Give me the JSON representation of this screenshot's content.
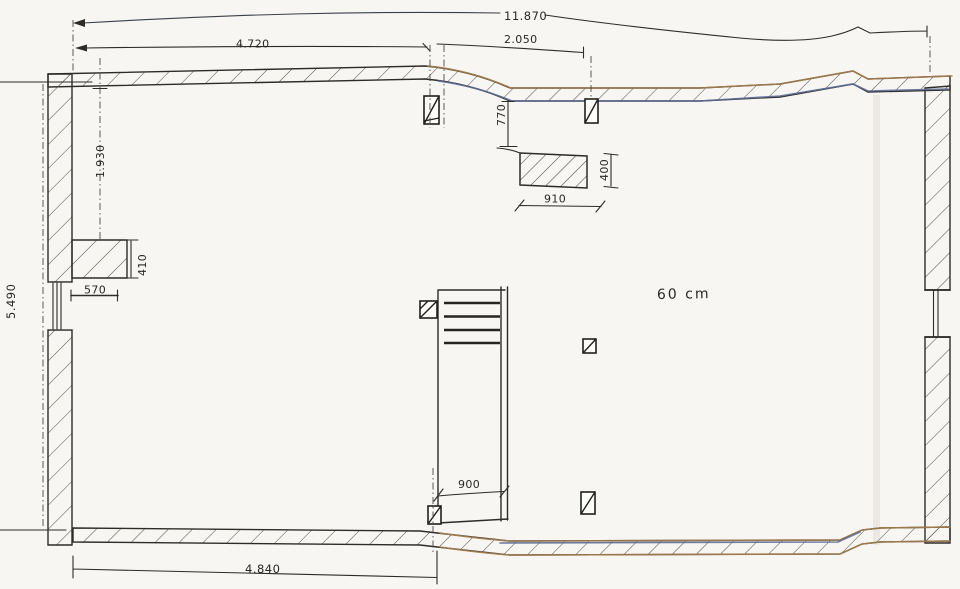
{
  "drawing": {
    "note": "60 cm",
    "dims": {
      "total_top": "11.870",
      "span_top_left": "4.720",
      "span_top_mid": "2.050",
      "height_left": "5.490",
      "upper_left_height": "1.930",
      "pier_depth": "410",
      "pier_offset": "570",
      "beam_offset": "770",
      "beam_height": "400",
      "beam_width": "910",
      "stair_width": "900",
      "span_bottom": "4.840"
    },
    "colors": {
      "ink": "#2e2c28",
      "tan": "#a8814f",
      "blue": "#5d6e96",
      "paper": "#f7f6f2",
      "faint_ink": "#b3afa5"
    }
  }
}
